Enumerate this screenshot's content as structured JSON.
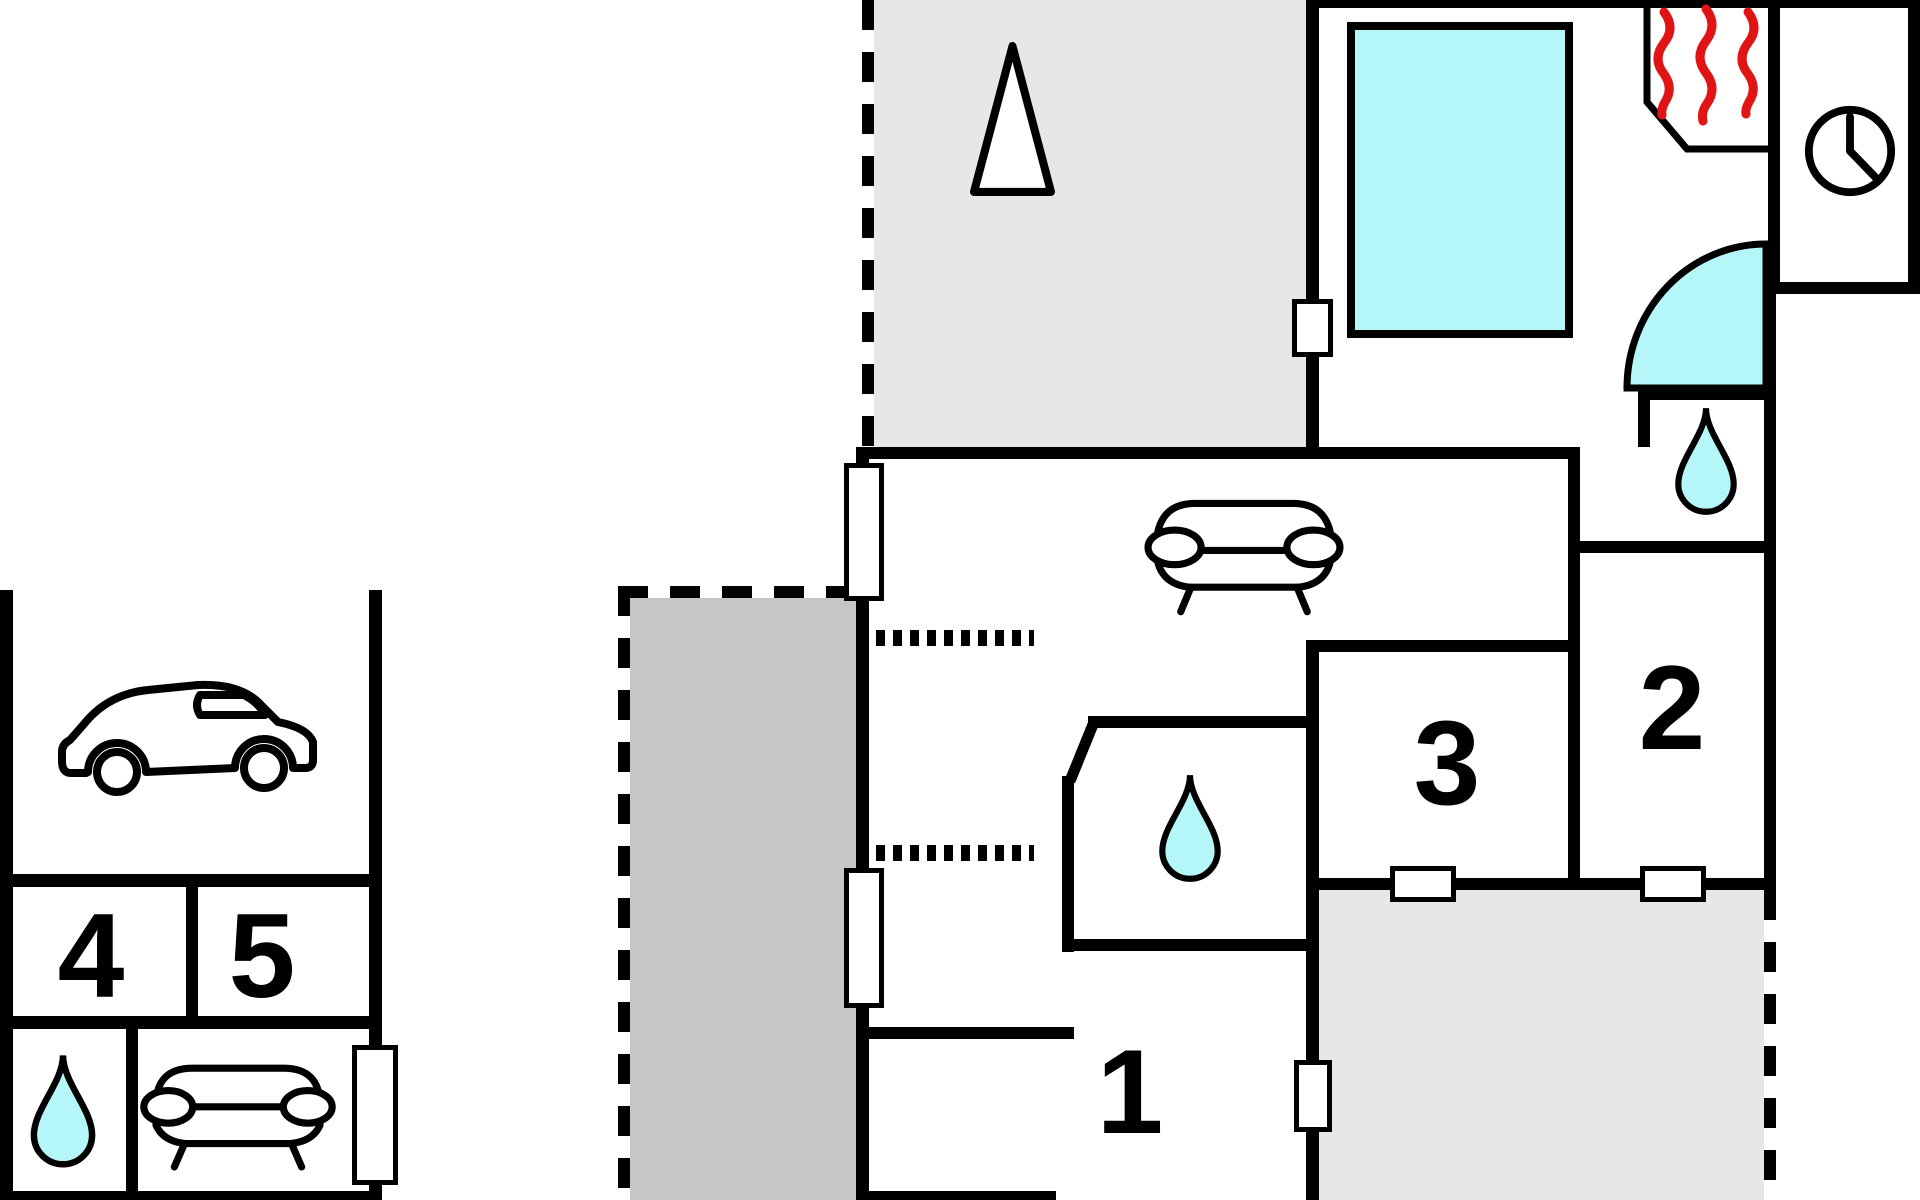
{
  "plan": {
    "type": "floor-plan",
    "labels": {
      "room1": "1",
      "room2": "2",
      "room3": "3",
      "room4": "4",
      "room5": "5"
    },
    "colors": {
      "wall": "#000000",
      "paper": "#ffffff",
      "water": "#b5f6f8",
      "heat": "#e01414",
      "terrace-light": "#e7e7e9",
      "terrace-dark": "#c6c6c8"
    },
    "icons": [
      "car-icon",
      "sofa-top-icon",
      "sofa-front-icon",
      "water-drop-icon",
      "tree-icon",
      "clock-icon",
      "heat-waves-icon",
      "door-swing-icon",
      "pool",
      "window-marker",
      "threshold-dots-icon"
    ]
  }
}
